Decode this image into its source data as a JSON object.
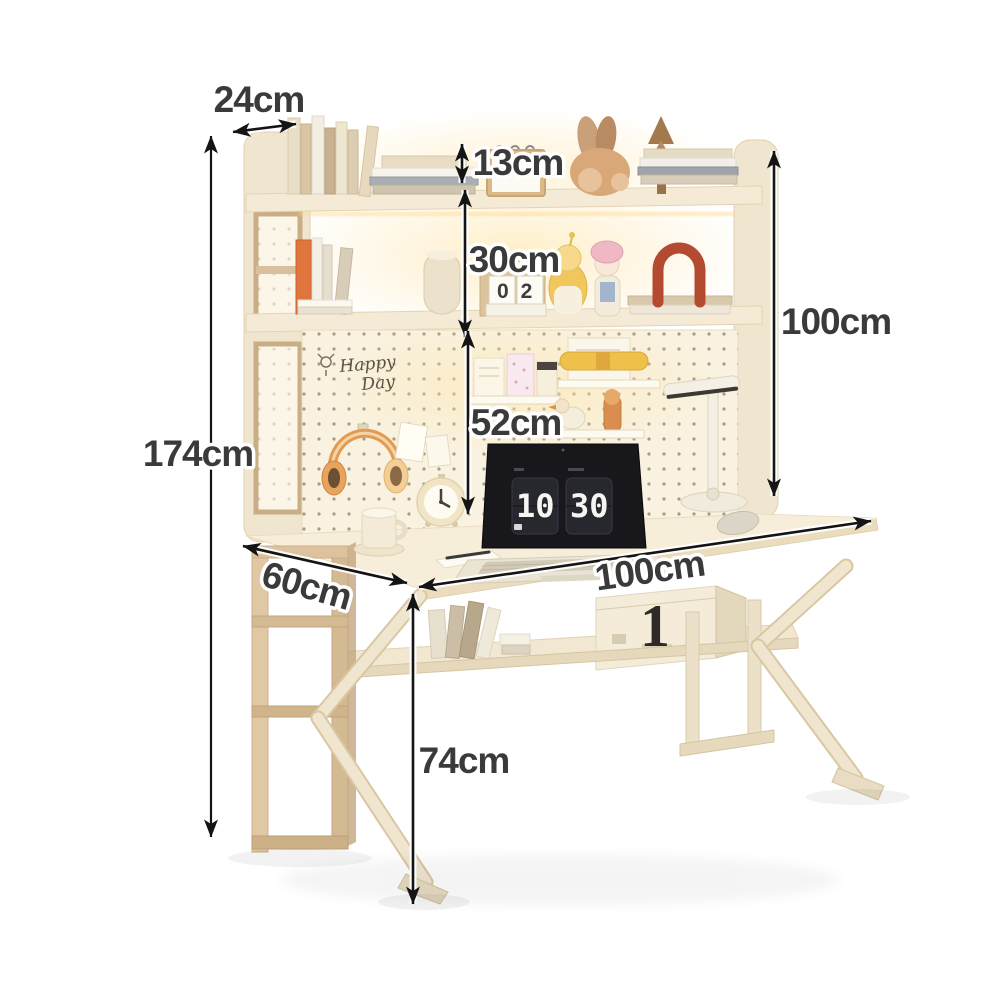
{
  "title": "Desk with bookshelf hutch dimension diagram",
  "colors": {
    "background": "#ffffff",
    "frame_cream": "#f0e6d0",
    "wood_tan": "#d9bf9e",
    "pegboard": "#f9f2e0",
    "warm_glow": "#ffe7ae",
    "label_text": "#3a3a3a",
    "arrow": "#141414",
    "headphone_orange": "#e59a50",
    "arch_red": "#b44a30",
    "book_orange": "#e0763c"
  },
  "dimensions": {
    "top_depth": "24cm",
    "top_shelf_clearance": "13cm",
    "shelf_spacing": "30cm",
    "hutch_height": "100cm",
    "total_height": "174cm",
    "pegboard_height": "52cm",
    "desk_depth": "60cm",
    "desk_width": "100cm",
    "desk_height": "74cm"
  },
  "decor": {
    "pegboard_sign_line1": "Happy",
    "pegboard_sign_line2": "Day",
    "cube_calendar": "02",
    "flip_clock_hours": "10",
    "flip_clock_minutes": "30",
    "box_mark": "1"
  }
}
